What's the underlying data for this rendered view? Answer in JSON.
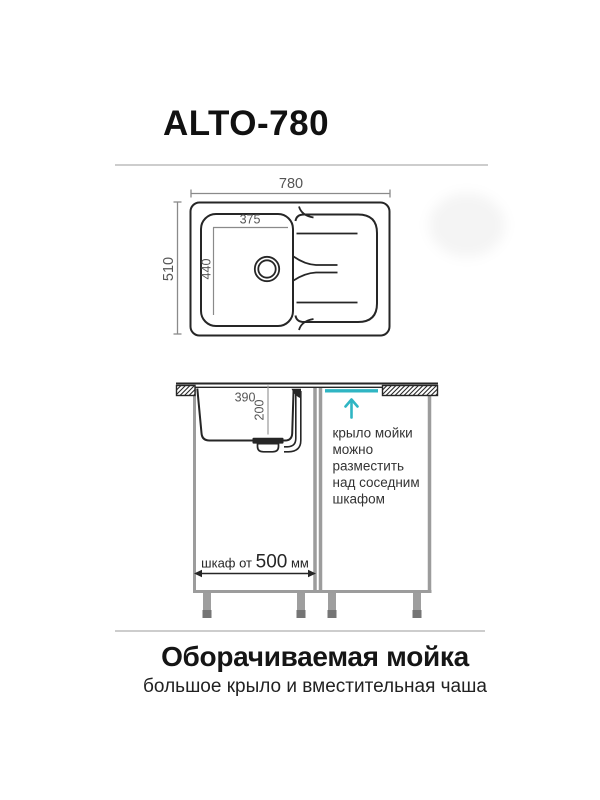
{
  "header": {
    "title": "ALTO-780"
  },
  "top_view": {
    "overall_width_mm": "780",
    "overall_depth_mm": "510",
    "bowl_width_mm": "375",
    "bowl_length_mm": "440"
  },
  "side_view": {
    "bowl_top_width_mm": "390",
    "bowl_depth_mm": "200",
    "note_lines": [
      "крыло мойки",
      "можно",
      "разместить",
      "над соседним",
      "шкафом"
    ],
    "cabinet_dim_prefix": "шкаф от ",
    "cabinet_dim_value": "500",
    "cabinet_dim_unit": " мм"
  },
  "footer": {
    "heading": "Оборачиваемая мойка",
    "subheading": "большое крыло и вместительная чаша"
  },
  "colors": {
    "accent_teal": "#2fb5c3",
    "drawing_line": "#262626",
    "dimension_gray": "#8a8a8a",
    "cabinet_gray": "#9c9c9c",
    "divider_gray": "#cdcdcd"
  }
}
